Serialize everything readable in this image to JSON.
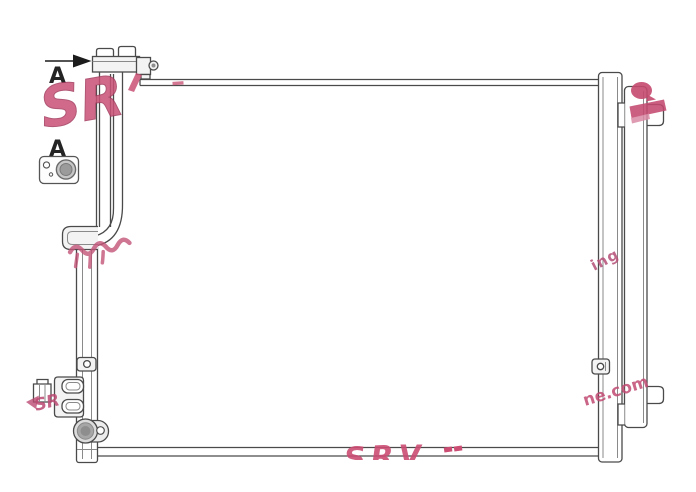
{
  "labels": {
    "section_arrow": "A",
    "detail_view": "A"
  },
  "watermarks": {
    "logo_main": "SR",
    "logo_mini": "SR",
    "logo_bottom": "SRV",
    "fragment_mid_right": "ing",
    "fragment_bottom_right": "ne.com"
  },
  "colors": {
    "background": "#ffffff",
    "line": "#4a4a4a",
    "line_light": "#8a8a8a",
    "fill_light": "#f3f3f3",
    "metal_gray": "#a6a6a6",
    "arrow_black": "#1c1c1c",
    "watermark_pink": "#c4496f",
    "watermark_pink_mid": "#ca5176",
    "watermark_pink_dark": "#a43a5e",
    "watermark_pink_light": "#d98aa5"
  }
}
